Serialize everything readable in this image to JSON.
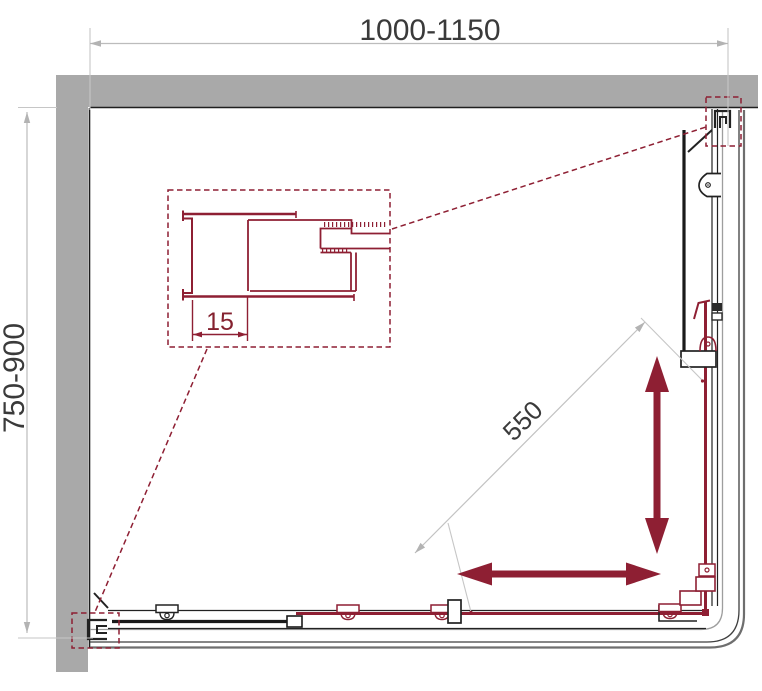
{
  "dimensions": {
    "width_range": "1000-1150",
    "depth_range": "750-900",
    "entry_diagonal": "550",
    "wall_profile_adjustment": "15"
  },
  "colors": {
    "wall_fill": "#a9a9a9",
    "accent_maroon": "#8e1f33",
    "dimension_gray": "#bcbcbc",
    "drawing_black": "#222222",
    "text_dark": "#3a3a3a",
    "background": "#ffffff"
  },
  "icons": {
    "slide_direction_horizontal": "double-arrow-horizontal",
    "slide_direction_vertical": "double-arrow-vertical"
  }
}
